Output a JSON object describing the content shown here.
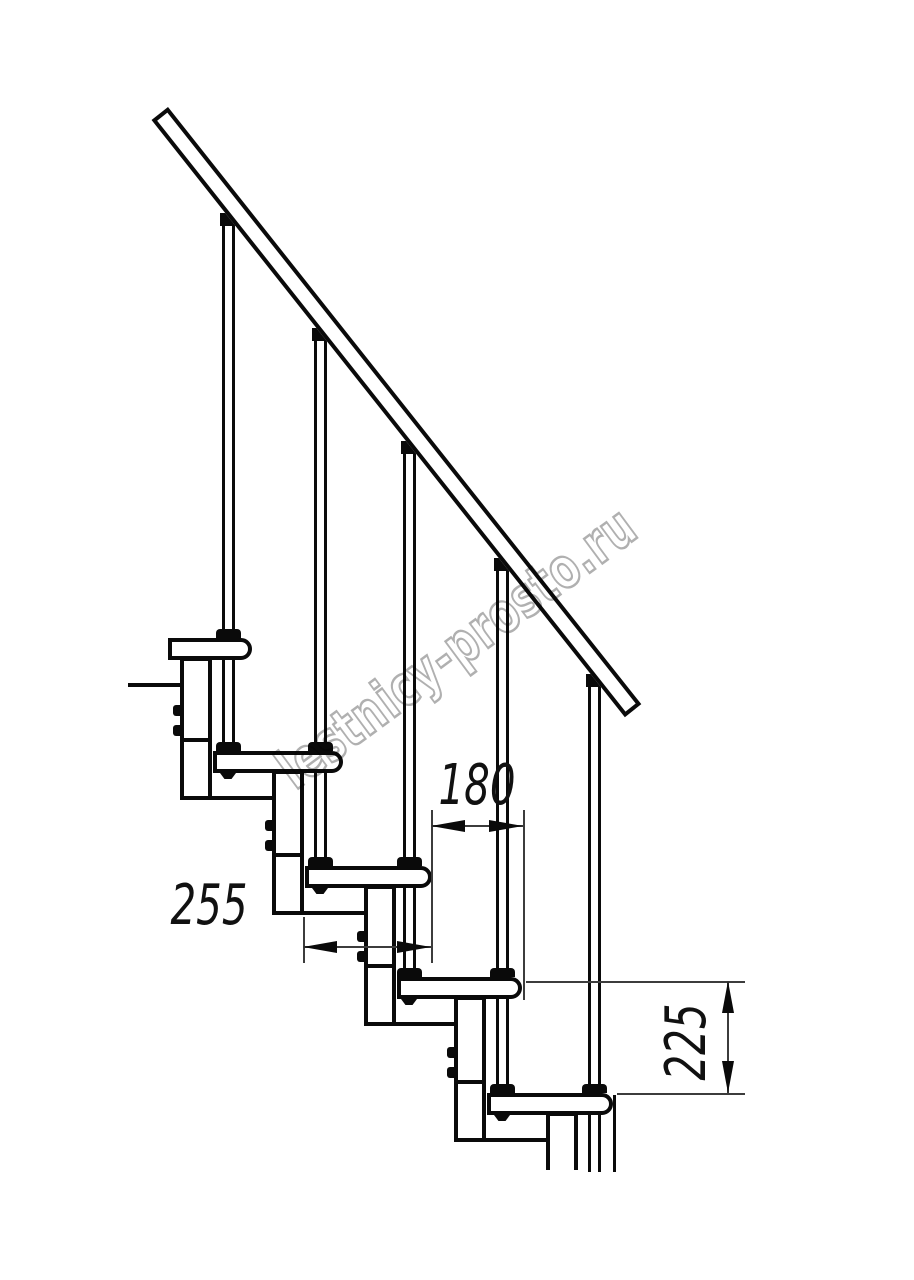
{
  "drawing": {
    "title": "modular staircase side-view technical drawing",
    "watermark": {
      "text": "lestnicy-prosto.ru",
      "color": "#a7a7a7"
    },
    "dimensions": {
      "run_label": "180",
      "depth_label": "255",
      "rise_label": "225"
    },
    "colors": {
      "line": "#0a0a0a",
      "thin_line": "#3c3c3c",
      "background": "#ffffff"
    }
  }
}
